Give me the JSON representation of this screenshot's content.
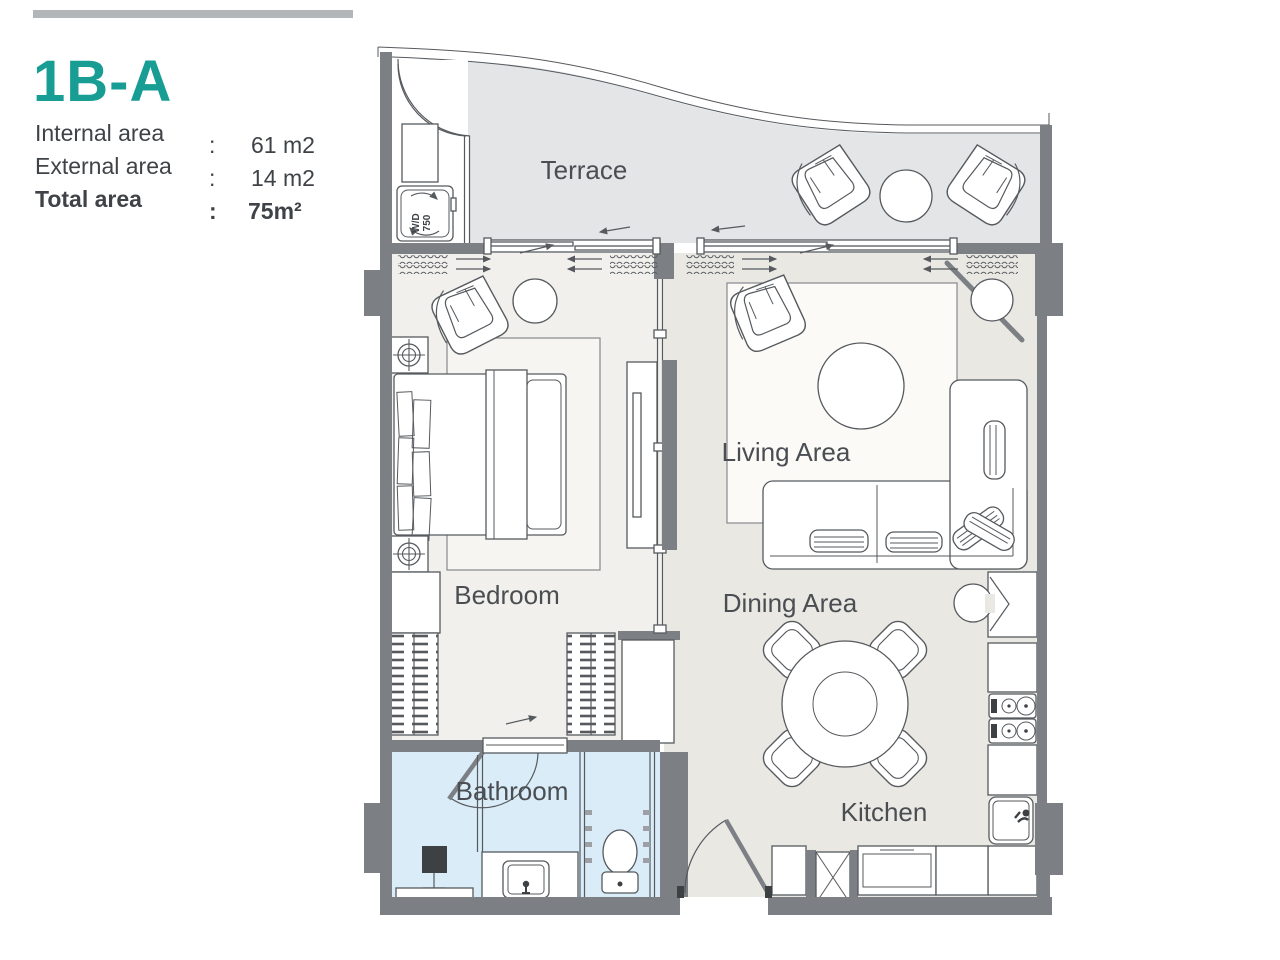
{
  "header": {
    "unit_code": "1B-A",
    "rows": [
      {
        "label": "Internal area",
        "sep": ":",
        "value": "61 m2"
      },
      {
        "label": "External area",
        "sep": ":",
        "value": "14 m2"
      },
      {
        "label": "Total area",
        "sep": ":",
        "value": "75m²"
      }
    ]
  },
  "rooms": {
    "terrace": "Terrace",
    "bedroom": "Bedroom",
    "living": "Living Area",
    "dining": "Dining Area",
    "kitchen": "Kitchen",
    "bathroom": "Bathroom"
  },
  "fixtures": {
    "washer_dryer_line1": "W/D",
    "washer_dryer_line2": "750"
  },
  "colors": {
    "accent_teal": "#189d95",
    "wall_gray": "#7c8084",
    "terrace_floor": "#e3e5e7",
    "bedroom_floor": "#f2f0ec",
    "living_floor": "#e9e8e3",
    "bathroom_floor": "#d9ecf7",
    "topbar_gray": "#b3b6b9",
    "text_gray": "#3f4347"
  }
}
